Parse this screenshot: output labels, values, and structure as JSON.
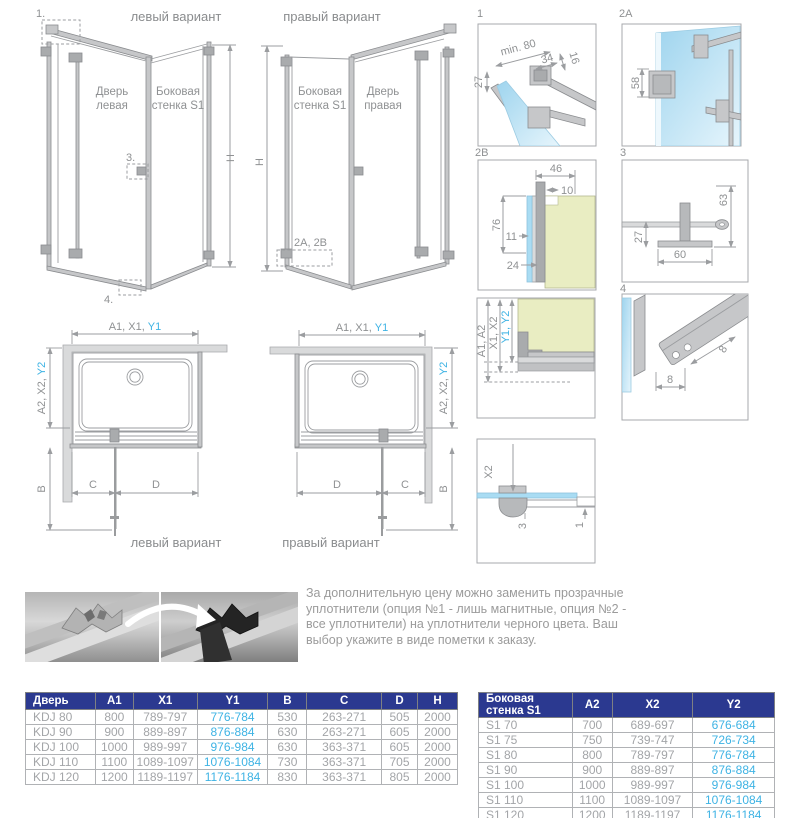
{
  "colors": {
    "accent_blue": "#3eb3e4",
    "table_header_bg": "#2b3990",
    "glass_blue": "#a9dcf3",
    "wall_green": "#e9edc2",
    "line_gray": "#9b9da0"
  },
  "iso_left": {
    "title": "левый вариант",
    "door_label_1": "Дверь",
    "door_label_2": "левая",
    "side_label_1": "Боковая",
    "side_label_2": "стенка S1",
    "height_label": "H",
    "callout_1": "1.",
    "callout_3": "3.",
    "callout_4": "4."
  },
  "iso_right": {
    "title": "правый вариант",
    "side_label_1": "Боковая",
    "side_label_2": "стенка S1",
    "door_label_1": "Дверь",
    "door_label_2": "правая",
    "height_label": "H",
    "callout_2": "2A, 2B"
  },
  "details": {
    "d1": {
      "label": "1",
      "dim_min": "min. 80",
      "dim_34": "34",
      "dim_16": "16",
      "dim_27": "27"
    },
    "d2a": {
      "label": "2A",
      "dim_58": "58"
    },
    "d2b": {
      "label": "2B",
      "dim_46": "46",
      "dim_10": "10",
      "dim_76": "76",
      "dim_11": "11",
      "dim_24": "24"
    },
    "d3": {
      "label": "3",
      "dim_63": "63",
      "dim_27": "27",
      "dim_60": "60"
    },
    "d4": {
      "label": "4",
      "dim_8a": "8",
      "dim_8b": "8"
    },
    "wall_section": {
      "dim_a": "A1, A2",
      "dim_x": "X1, X2",
      "dim_y": "Y1, Y2"
    },
    "bottom_section": {
      "dim_x2": "X2",
      "dim_3": "3",
      "dim_1": "1"
    }
  },
  "plan_left": {
    "top_dim_gray": "A1, X1,",
    "top_dim_blue": "Y1",
    "side_dim_gray": "A2, X2,",
    "side_dim_blue": "Y2",
    "dim_b": "B",
    "dim_c": "C",
    "dim_d": "D",
    "caption": "левый вариант"
  },
  "plan_right": {
    "top_dim_gray": "A1, X1,",
    "top_dim_blue": "Y1",
    "side_dim_gray": "A2, X2,",
    "side_dim_blue": "Y2",
    "dim_b": "B",
    "dim_c": "C",
    "dim_d": "D",
    "caption": "правый вариант"
  },
  "note_text": "За дополнительную цену можно заменить прозрачные уплотнители (опция №1 - лишь магнитные, опция №2 - все уплотнители) на уплотнители черного цвета. Ваш выбор укажите в виде пометки к заказу.",
  "door_table": {
    "headers": [
      "Дверь",
      "A1",
      "X1",
      "Y1",
      "B",
      "C",
      "D",
      "H"
    ],
    "blue_col": 3,
    "rows": [
      [
        "KDJ 80",
        "800",
        "789-797",
        "776-784",
        "530",
        "263-271",
        "505",
        "2000"
      ],
      [
        "KDJ 90",
        "900",
        "889-897",
        "876-884",
        "630",
        "263-271",
        "605",
        "2000"
      ],
      [
        "KDJ 100",
        "1000",
        "989-997",
        "976-984",
        "630",
        "363-371",
        "605",
        "2000"
      ],
      [
        "KDJ 110",
        "1100",
        "1089-1097",
        "1076-1084",
        "730",
        "363-371",
        "705",
        "2000"
      ],
      [
        "KDJ 120",
        "1200",
        "1189-1197",
        "1176-1184",
        "830",
        "363-371",
        "805",
        "2000"
      ]
    ]
  },
  "side_table": {
    "headers": [
      "Боковая стенка S1",
      "A2",
      "X2",
      "Y2"
    ],
    "blue_col": 3,
    "rows": [
      [
        "S1 70",
        "700",
        "689-697",
        "676-684"
      ],
      [
        "S1 75",
        "750",
        "739-747",
        "726-734"
      ],
      [
        "S1 80",
        "800",
        "789-797",
        "776-784"
      ],
      [
        "S1 90",
        "900",
        "889-897",
        "876-884"
      ],
      [
        "S1 100",
        "1000",
        "989-997",
        "976-984"
      ],
      [
        "S1 110",
        "1100",
        "1089-1097",
        "1076-1084"
      ],
      [
        "S1 120",
        "1200",
        "1189-1197",
        "1176-1184"
      ]
    ]
  }
}
